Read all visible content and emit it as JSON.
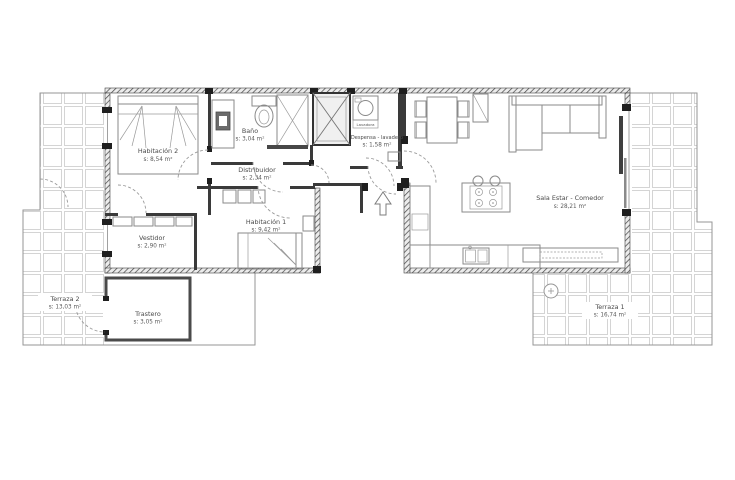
{
  "rooms": {
    "habitacion2": {
      "name": "Habitación 2",
      "area": "s: 8,54 m²"
    },
    "bano": {
      "name": "Baño",
      "area": "s: 3,04 m²"
    },
    "distribuidor": {
      "name": "Distribuidor",
      "area": "s: 2,34 m²"
    },
    "vestidor": {
      "name": "Vestidor",
      "area": "s: 2,90 m²"
    },
    "habitacion1": {
      "name": "Habitación 1",
      "area": "s: 9,42 m²"
    },
    "despensa": {
      "name": "Despensa - lavadero",
      "area": "s: 1,58 m²"
    },
    "sala": {
      "name": "Sala Estar - Comedor",
      "area": "s: 28,21 m²"
    },
    "trastero": {
      "name": "Trastero",
      "area": "s: 3,05 m²"
    },
    "terraza1": {
      "name": "Terraza 1",
      "area": "s: 16,74 m²"
    },
    "terraza2": {
      "name": "Terraza 2",
      "area": "s: 13,03 m²"
    }
  },
  "labels": {
    "lavadora": "Lavadora"
  },
  "colors": {
    "wall": "#3a3a3a",
    "furniture": "#8a8a8a",
    "tile": "#cacaca",
    "text": "#4a4a4a",
    "background": "#ffffff"
  }
}
